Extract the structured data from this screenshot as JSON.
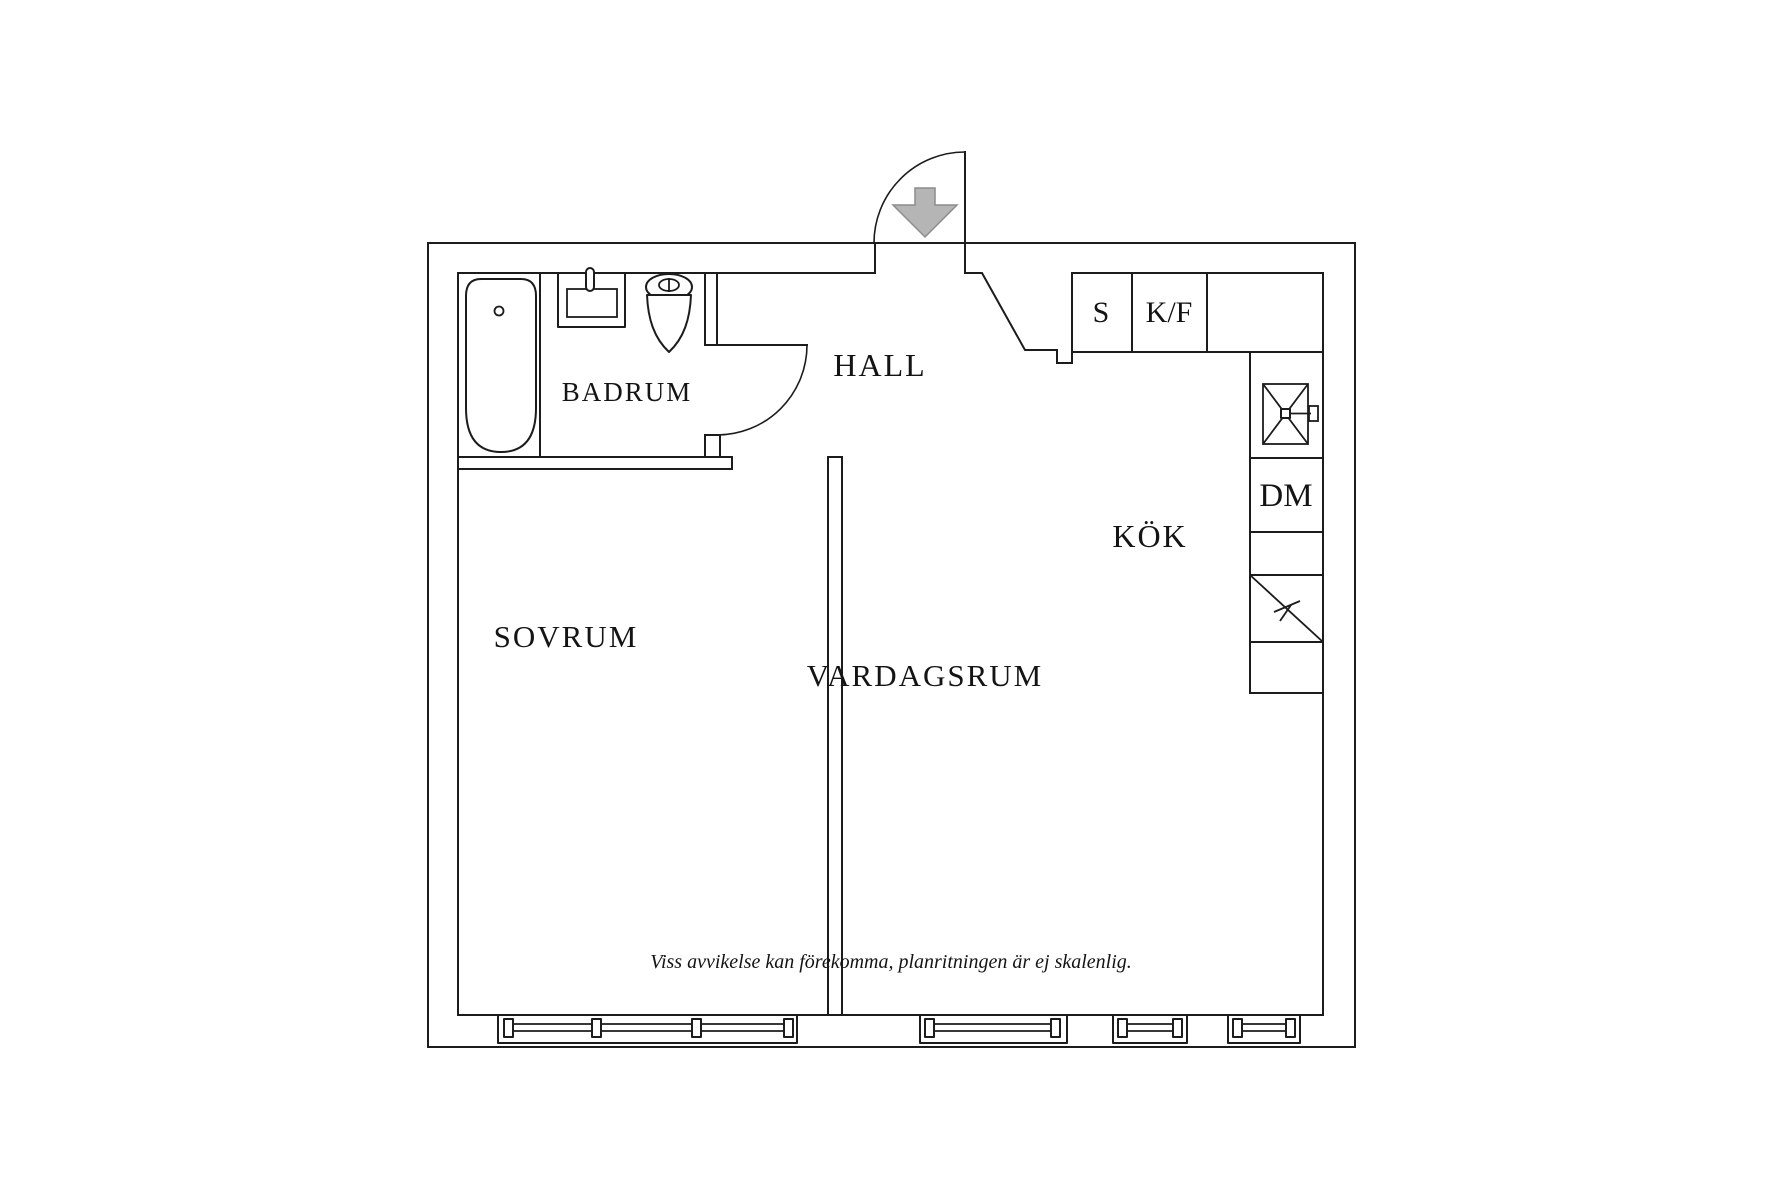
{
  "floorplan": {
    "labels": {
      "bathroom": "BADRUM",
      "hall": "HALL",
      "bedroom": "SOVRUM",
      "living_room": "VARDAGSRUM",
      "kitchen": "KÖK",
      "cabinet_s": "S",
      "fridge_freezer": "K/F",
      "dishwasher": "DM"
    },
    "disclaimer": "Viss avvikelse kan förekomma, planritningen är ej skalenlig.",
    "colors": {
      "line": "#1c1c1c",
      "text": "#141414",
      "arrow_fill": "#b5b5b5",
      "arrow_stroke": "#8c8c8c",
      "background": "#ffffff"
    },
    "icons": {
      "entrance": "entrance-arrow-icon",
      "bath": "bathtub-icon",
      "washbasin": "washbasin-icon",
      "toilet": "toilet-icon",
      "kitchen_sink": "kitchen-sink-icon",
      "stove": "stove-icon",
      "windows": "window-icon"
    }
  }
}
